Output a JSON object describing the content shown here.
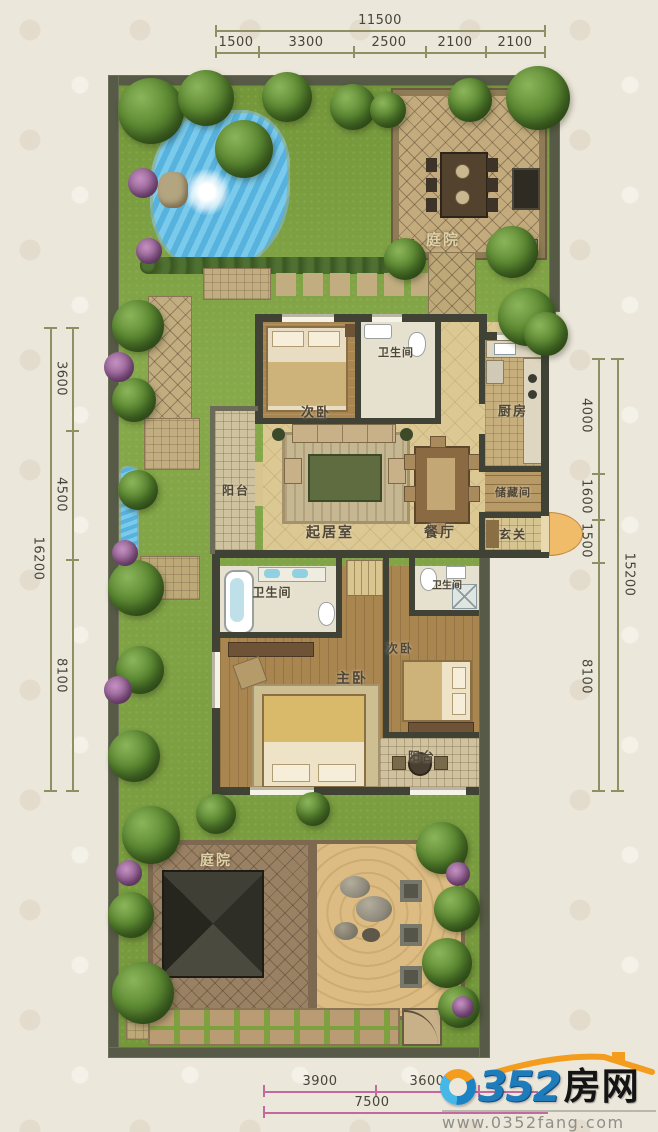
{
  "dimensions": {
    "top": {
      "total": "11500",
      "segments": [
        "1500",
        "3300",
        "2500",
        "2100",
        "2100"
      ]
    },
    "left": {
      "total": "16200",
      "segments": [
        "3600",
        "4500",
        "8100"
      ]
    },
    "right": {
      "total": "15200",
      "segments": [
        "4000",
        "1600",
        "1500",
        "8100"
      ]
    },
    "bottom": {
      "total": "7500",
      "segments": [
        "3900",
        "3600"
      ]
    }
  },
  "rooms": {
    "courtyard_top": {
      "label": "庭院"
    },
    "bedroom2_upper": {
      "label": "次卧"
    },
    "bath_upper": {
      "label": "卫生间"
    },
    "kitchen": {
      "label": "厨房"
    },
    "balcony_left": {
      "label": "阳台"
    },
    "living": {
      "label": "起居室"
    },
    "dining": {
      "label": "餐厅"
    },
    "storage": {
      "label": "储藏间"
    },
    "foyer": {
      "label": "玄关"
    },
    "bath_lower_left": {
      "label": "卫生间"
    },
    "bath_lower_right": {
      "label": "卫生间"
    },
    "master_bedroom": {
      "label": "主卧"
    },
    "bedroom2_lower": {
      "label": "次卧"
    },
    "balcony_lower": {
      "label": "阳台"
    },
    "courtyard_bottom": {
      "label": "庭院"
    }
  },
  "watermark": {
    "number": "352",
    "zero": "0",
    "cn": "房网",
    "url": "www.0352fang.com"
  },
  "colors": {
    "wall": "#565a46",
    "lawn": "#7fa443",
    "water": "#5fb7e2",
    "sand": "#dcbc82",
    "dim_line": "#8f8f63",
    "dim_line_bottom": "#c4699d",
    "logo_blue": "#1f7cba",
    "logo_orange": "#f39c1d"
  }
}
